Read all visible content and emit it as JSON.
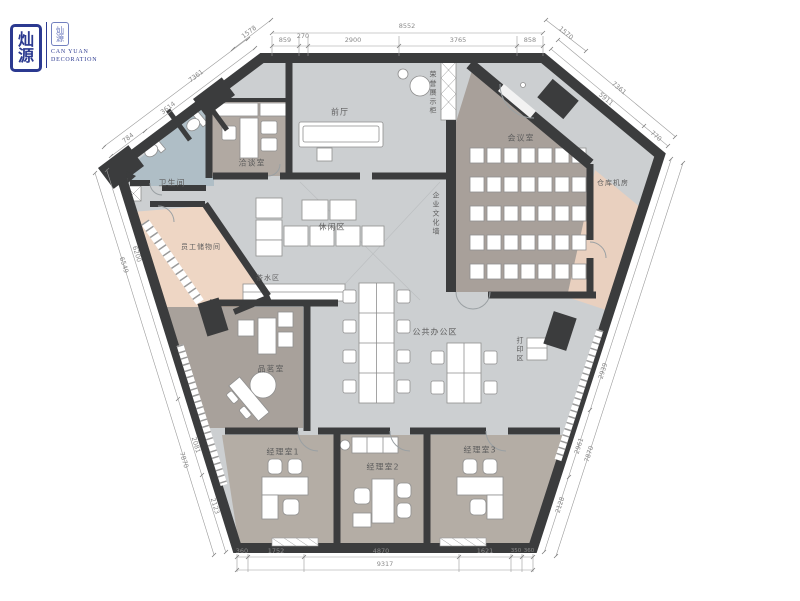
{
  "logo": {
    "seal_char_top": "灿",
    "seal_char_bottom": "源",
    "stamp_text": "灿源",
    "company_en_1": "CAN YUAN",
    "company_en_2": "DECORATION"
  },
  "rooms": {
    "bathroom": "卫生间",
    "negotiation_room": "洽谈室",
    "lobby": "前厅",
    "honor_display": "荣誉展示柜",
    "meeting_room": "会议室",
    "warehouse_server": "仓库机房",
    "culture_wall": "企业文化墙",
    "leisure_area": "休闲区",
    "staff_lockers": "员工储物间",
    "tea_station": "茶水区",
    "open_office": "公共办公区",
    "print_area": "打印区",
    "tea_room": "品茗室",
    "manager_office_1": "经理室1",
    "manager_office_2": "经理室2",
    "manager_office_3": "经理室3"
  },
  "dimensions": {
    "top_total": "8552",
    "top_seg_1": "859",
    "top_seg_2": "270",
    "top_seg_3": "2900",
    "top_seg_4": "3765",
    "top_seg_5": "858",
    "top_left_diag": "1578",
    "top_right_diag": "1570",
    "left_shoulder_outer": "7361",
    "left_shoulder_inner": "3614",
    "left_shoulder_small": "784",
    "left_edge_outer": "6549",
    "left_edge_inner": "6200",
    "left_lower_outer": "7870",
    "left_lower_seg_1": "2081",
    "left_lower_seg_2": "2123",
    "bottom_total": "9317",
    "bottom_seg_1": "360",
    "bottom_seg_2": "1752",
    "bottom_seg_3": "4870",
    "bottom_seg_4": "1621",
    "bottom_seg_5": "350",
    "bottom_seg_6": "360",
    "right_edge_outer": "7870",
    "right_edge_seg_1": "2939",
    "right_edge_seg_2": "2961",
    "right_edge_seg_3": "2128",
    "right_shoulder_outer": "7361",
    "right_shoulder_inner": "5911",
    "right_shoulder_small": "770"
  },
  "colors": {
    "logo_blue": "#2b3990",
    "wall_dark": "#3b3c3d",
    "floor_gray": "#cccfd1",
    "floor_taupe": "#a8a09a",
    "floor_peach": "#eed6c4",
    "floor_bath": "#afbec6"
  }
}
